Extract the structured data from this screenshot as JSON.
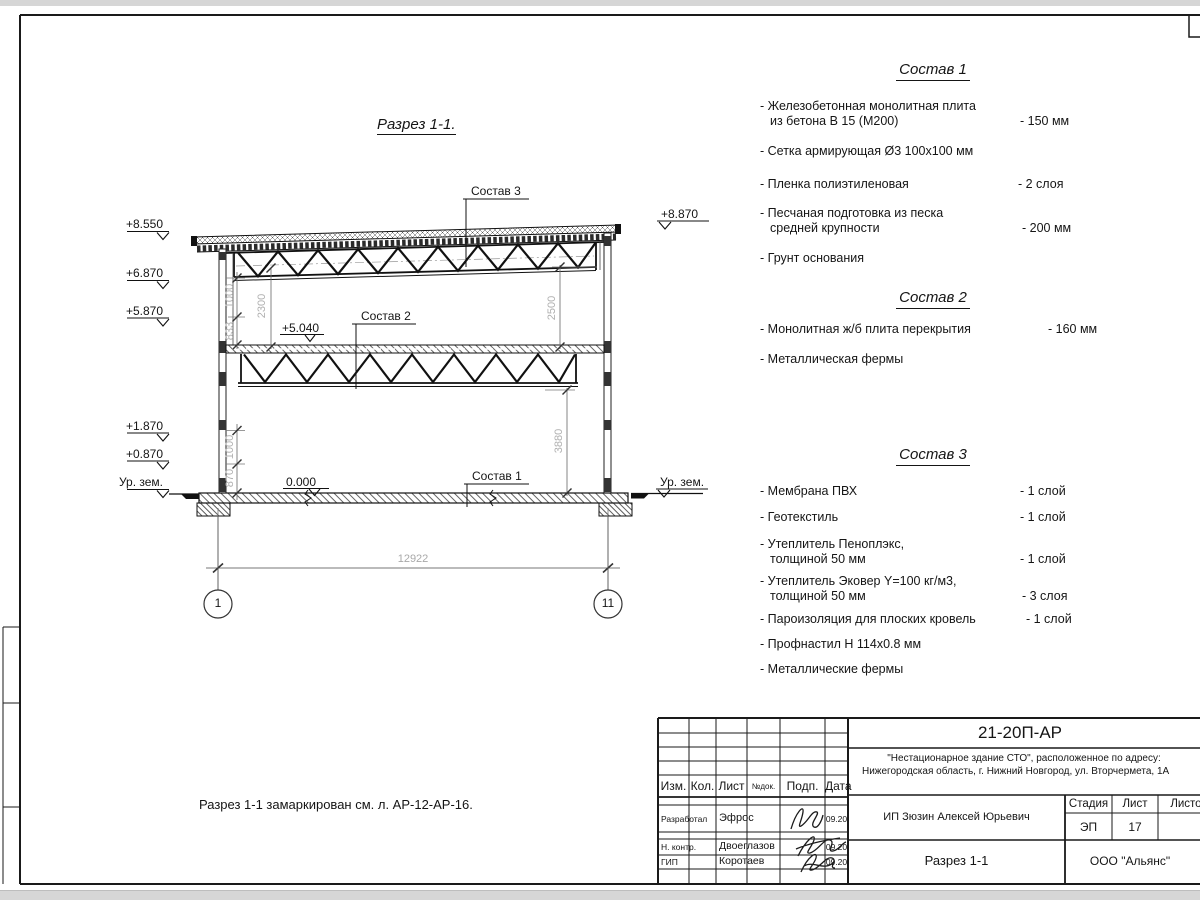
{
  "page": {
    "section_view_title": "Разрез 1-1.",
    "note": "Разрез 1-1 замаркирован см. л. АР-12-АР-16."
  },
  "drawing": {
    "callouts": {
      "c1": "Состав 1",
      "c2": "Состав 2",
      "c3": "Состав 3"
    },
    "levels": {
      "left": [
        "+8.550",
        "+6.870",
        "+5.870",
        "+1.870",
        "+0.870",
        "Ур. зем."
      ],
      "right_top": "+8.870",
      "right_ground": "Ур. зем.",
      "floor": "0.000",
      "mid_slab": "+5.040"
    },
    "dimensions": {
      "span": "12922",
      "upper_1000": "1000",
      "upper_833": "833",
      "upper_2300": "2300",
      "right_2500": "2500",
      "right_3880": "3880",
      "lower_1000": "1000",
      "lower_870": "870"
    },
    "axes": {
      "left": "1",
      "right": "11"
    }
  },
  "sostav1": {
    "title": "Состав 1",
    "items": [
      {
        "name": "- Железобетонная  монолитная плита\nиз бетона В 15 (М200)",
        "value": "- 150 мм"
      },
      {
        "name": "- Сетка армирующая Ø3 100х100 мм",
        "value": ""
      },
      {
        "name": "- Пленка полиэтиленовая",
        "value": "- 2 слоя"
      },
      {
        "name": "- Песчаная подготовка из песка\nсредней крупности",
        "value": "- 200 мм"
      },
      {
        "name": "- Грунт основания",
        "value": ""
      }
    ]
  },
  "sostav2": {
    "title": "Состав 2",
    "items": [
      {
        "name": "- Монолитная ж/б плита перекрытия",
        "value": "- 160 мм"
      },
      {
        "name": "- Металлическая фермы",
        "value": ""
      }
    ]
  },
  "sostav3": {
    "title": "Состав 3",
    "items": [
      {
        "name": "- Мембрана ПВХ",
        "value": "- 1 слой"
      },
      {
        "name": "- Геотекстиль",
        "value": "- 1 слой"
      },
      {
        "name": "- Утеплитель Пеноплэкс,\nтолщиной 50 мм",
        "value": "- 1 слой"
      },
      {
        "name": "- Утеплитель Эковер Y=100 кг/м3,\nтолщиной 50 мм",
        "value": "- 3 слоя"
      },
      {
        "name": "- Пароизоляция для плоских кровель",
        "value": "- 1 слой"
      },
      {
        "name": "- Профнастил Н 114х0.8 мм",
        "value": ""
      },
      {
        "name": "- Металлические фермы",
        "value": ""
      }
    ]
  },
  "titleblock": {
    "doc_number": "21-20П-АР",
    "project_line1": "\"Нестационарное здание СТО\", расположенное по адресу:",
    "project_line2": "Нижегородская область, г. Нижний Новгород, ул. Вторчермета, 1А",
    "client": "ИП Зюзин Алексей Юрьевич",
    "drawing_title": "Разрез 1-1",
    "company": "ООО \"Альянс\"",
    "col_headers": {
      "izm": "Изм.",
      "kol": "Кол.",
      "list": "Лист",
      "ndoc": "№док.",
      "podp": "Подп.",
      "data": "Дата"
    },
    "stage_headers": {
      "stadia": "Стадия",
      "list": "Лист",
      "listov": "Листов"
    },
    "stage": "ЭП",
    "sheet": "17",
    "rows": [
      {
        "role": "Разработал",
        "name": "Эфрос",
        "date": "09.20"
      },
      {
        "role": "Н. контр.",
        "name": "Двоеглазов",
        "date": "09.20"
      },
      {
        "role": "ГИП",
        "name": "Коротаев",
        "date": "09.20"
      }
    ]
  }
}
